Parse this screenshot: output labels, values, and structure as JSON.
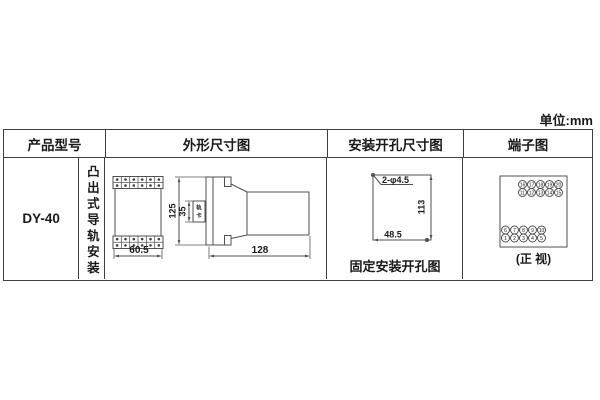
{
  "unit_label": "单位:mm",
  "colors": {
    "border": "#3f3f3f",
    "line": "#4f4f4f",
    "text": "#1a1a1a"
  },
  "table": {
    "headers": {
      "product_model": "产品型号",
      "outline": "外形尺寸图",
      "mounting_holes": "安装开孔尺寸图",
      "terminals": "端子图"
    },
    "row": {
      "model": "DY-40",
      "mounting_type": "凸出式导轨安装",
      "outline": {
        "front_width": "60.5",
        "height": "125",
        "rail_width": "35",
        "rail_clip": "轨卡",
        "depth": "128",
        "terminal_strip": {
          "columns": 6,
          "rows": 2
        }
      },
      "holes": {
        "spec": "2-φ4.5",
        "v_spacing": "113",
        "h_spacing": "48.5",
        "caption": "固定安装开孔图"
      },
      "terminals": {
        "top_rows": [
          [
            "16",
            "17",
            "18",
            "19",
            "20"
          ],
          [
            "11",
            "12",
            "13",
            "14",
            "15"
          ]
        ],
        "bottom_rows": [
          [
            "6",
            "7",
            "8",
            "9",
            "10"
          ],
          [
            "1",
            "2",
            "3",
            "4",
            "5"
          ]
        ],
        "caption": "(正 视)"
      }
    }
  }
}
